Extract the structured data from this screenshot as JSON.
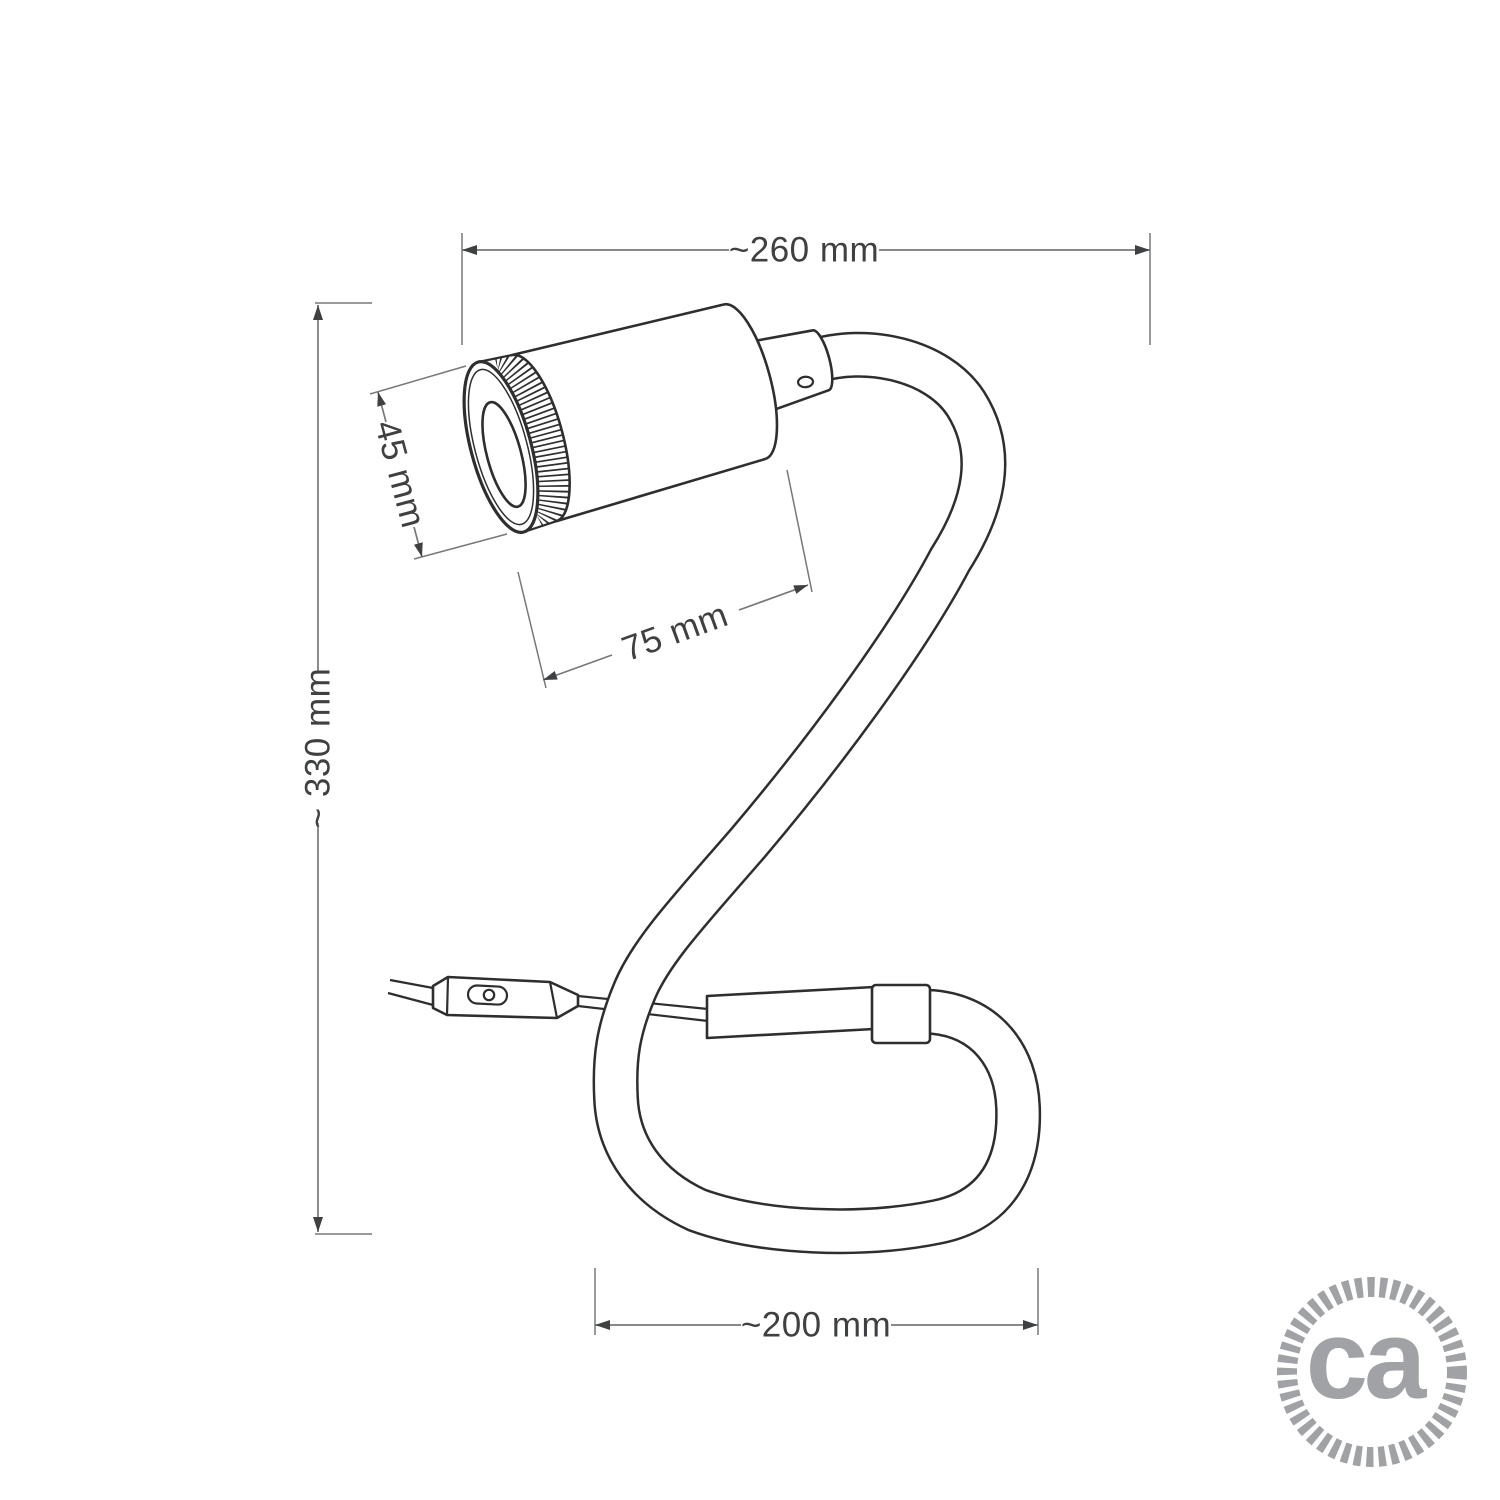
{
  "figure": {
    "kind": "technical dimension drawing",
    "subject": "flexible gooseneck spotlight lamp"
  },
  "dimensions": {
    "overall_width": "~260 mm",
    "overall_height": "~ 330 mm",
    "spot_diameter": "45 mm",
    "spot_length": "75 mm",
    "loop_width": "~200 mm"
  },
  "logo": {
    "text": "ca",
    "color": "#a0a2a5"
  },
  "colors": {
    "background": "#ffffff",
    "drawing_line": "#2e2e2e",
    "dimension_line": "#77787b",
    "dimension_text": "#3f4041"
  }
}
